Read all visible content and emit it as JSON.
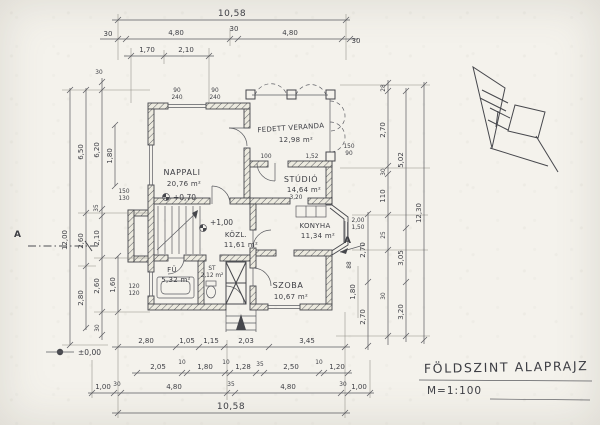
{
  "sheet": {
    "title": "FÖLDSZINT ALAPRAJZ",
    "scale": "M=1:100"
  },
  "rooms": {
    "nappali": {
      "name": "NAPPALI",
      "area": "20,76 m²"
    },
    "veranda": {
      "name": "FEDETT VERANDA",
      "area": "12,98 m²"
    },
    "studio": {
      "name": "STÚDIÓ",
      "area": "14,64 m²",
      "inner_dim": "3,20"
    },
    "konyha": {
      "name": "KONYHA",
      "area": "11,34 m²"
    },
    "kozl": {
      "name": "KÖZL.",
      "area": "11,61 m²"
    },
    "szoba": {
      "name": "SZOBA",
      "area": "10,67 m²"
    },
    "furdo": {
      "name": "FÜ",
      "area": "5,32 m²"
    },
    "kamra": {
      "name": "ST",
      "area": "2,12 m²"
    }
  },
  "levels": {
    "terrain": "±0,00",
    "nappali": "+0,70",
    "kozl": "+1,00"
  },
  "sections": {
    "left": "A",
    "right": "A"
  },
  "dims": {
    "top": {
      "total": "10,58",
      "seg": [
        "30",
        "4,80",
        "30",
        "4,80",
        "30"
      ],
      "sub": [
        "1,70",
        "2,10"
      ]
    },
    "bottom": {
      "r1": [
        "2,80",
        "1,05",
        "1,15",
        "2,03",
        "3,45"
      ],
      "r2": [
        "2,05",
        "10",
        "1,80",
        "10",
        "1,28",
        "35",
        "2,50",
        "10",
        "1,20"
      ],
      "r3": [
        "1,00",
        "30",
        "4,80",
        "35",
        "4,80",
        "30",
        "1,00"
      ],
      "total": "10,58"
    },
    "left": {
      "total": "12,00",
      "c2": [
        "6,50",
        "2,60",
        "2,80"
      ],
      "c3": [
        "30",
        "6,20",
        "35",
        "2,10",
        "2,60",
        "30"
      ],
      "near": [
        "1,80",
        "1,60"
      ]
    },
    "right": {
      "total": "12,30",
      "c2": [
        "5,02",
        "3,05",
        "3,20"
      ],
      "c3": [
        "28",
        "2,70",
        "30",
        "110",
        "25",
        "30"
      ],
      "near": [
        "2,70",
        "2,70",
        "1,80",
        "88"
      ]
    }
  },
  "annotations": {
    "win_top_1": {
      "a": "90",
      "b": "240"
    },
    "win_top_2": {
      "a": "90",
      "b": "240"
    },
    "win_left_1": {
      "a": "150",
      "b": "130"
    },
    "win_left_2": {
      "a": "120",
      "b": "120"
    },
    "win_right_1": {
      "a": "2,00",
      "b": "1,50"
    },
    "win_ver_1": {
      "a": "150",
      "b": "90"
    },
    "door_studio": "1,52",
    "ver_dim": "100"
  }
}
